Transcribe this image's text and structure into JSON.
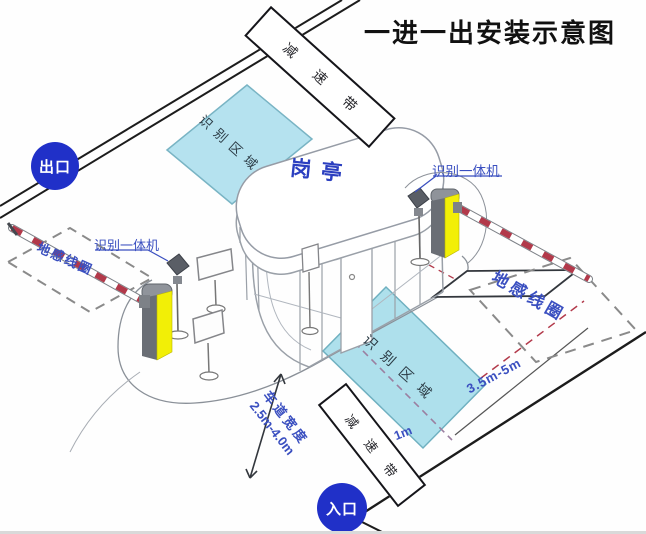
{
  "title": "一进一出安装示意图",
  "badges": {
    "exit": "出口",
    "entrance": "入口"
  },
  "booth": {
    "label": "岗亭"
  },
  "areas": {
    "recognition_top": "识别区域",
    "recognition_bottom": "识别区域",
    "coil_left": "地感线圈",
    "coil_right": "地感线圈"
  },
  "bands": {
    "top": "减速带",
    "bottom": "减速带"
  },
  "devices": {
    "left_reader": "识别一体机",
    "right_reader": "识别一体机"
  },
  "dimensions": {
    "lane_width_label": "车道宽度",
    "lane_width_value": "2.5m-4.0m",
    "coil_distance": "3.5m-5m",
    "offset": "1m"
  },
  "colors": {
    "badge_blue": "#2030c8",
    "label_blue": "#3a4fc0",
    "area_fill": "#b5e2ef",
    "area_border": "#79b4c4",
    "machine_yellow": "#f2ef06",
    "arm_red": "#b2394a",
    "line_black": "#1c1c1c"
  }
}
